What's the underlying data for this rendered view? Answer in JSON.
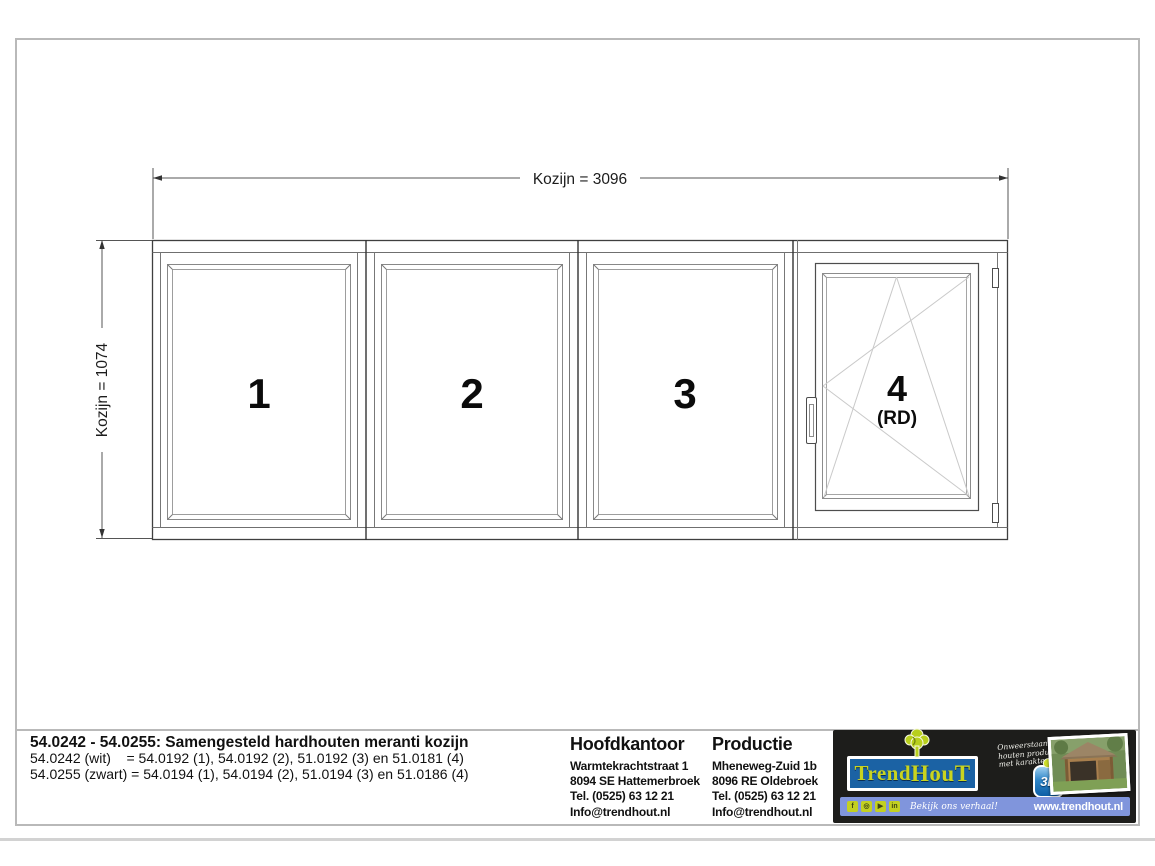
{
  "drawing": {
    "dim_width_label": "Kozijn = 3096",
    "dim_height_label": "Kozijn = 1074",
    "panels": [
      {
        "label": "1"
      },
      {
        "label": "2"
      },
      {
        "label": "3"
      },
      {
        "label": "4",
        "sub_label": "(RD)"
      }
    ]
  },
  "title_block": {
    "title": "54.0242 - 54.0255: Samengesteld hardhouten meranti kozijn",
    "variant_lines": [
      "54.0242 (wit)    = 54.0192 (1), 54.0192 (2), 51.0192 (3) en 51.0181 (4)",
      "54.0255 (zwart) = 54.0194 (1), 54.0194 (2), 51.0194 (3) en 51.0186 (4)"
    ],
    "hoofdkantoor": {
      "heading": "Hoofdkantoor",
      "lines": [
        "Warmtekrachtstraat 1",
        "8094 SE Hattemerbroek",
        "Tel. (0525) 63 12 21",
        "Info@trendhout.nl"
      ]
    },
    "productie": {
      "heading": "Productie",
      "lines": [
        "Mheneweg-Zuid 1b",
        "8096 RE Oldebroek",
        "Tel. (0525) 63 12 21",
        "Info@trendhout.nl"
      ]
    }
  },
  "branding": {
    "logo_text_1": "Trend",
    "logo_text_2": "HouT",
    "tagline_lines": [
      "Onweerstaanbare",
      "houten producten",
      "met karakter"
    ],
    "badge_3d_label": "3D",
    "cta_text": "Bekijk ons verhaal!",
    "website": "www.trendhout.nl",
    "colors": {
      "black_bg": "#1d1d1b",
      "logo_blue": "#1b62a4",
      "brand_green": "#c3d021",
      "bar_blue": "#8095dc"
    }
  }
}
